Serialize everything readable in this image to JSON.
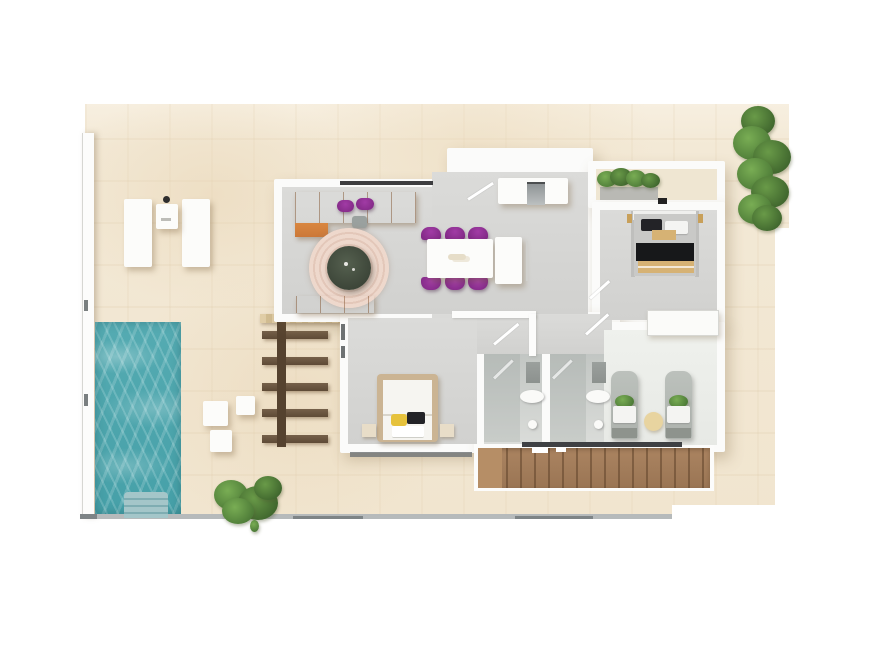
{
  "meta": {
    "title": "3D floor plan rendering of a single-storey villa with pool",
    "render_style": "top-down 3D architectural visualization",
    "visible_text": "none"
  },
  "palette": {
    "page_background": "#ffffff",
    "ground_sand": "#f3e9d6",
    "pool_water": "#4ba4ab",
    "pool_steps": "#a4c6c9",
    "interior_floor": "#d6d6d4",
    "bathroom_floor": "#c6cac7",
    "walls_white": "#fbfbfa",
    "sofa_orange": "#d07c3b",
    "accent_purple": "#8b2e90",
    "rug_pink": "#e8d0c3",
    "coffee_table_green": "#434c3e",
    "stairs_wood": "#a07b59",
    "pergola_brown": "#65503b",
    "plant_green": "#5d8f44",
    "bed_blanket_black": "#17181a",
    "bed_wood_tan": "#d6b274",
    "bed_frame_beige": "#cbb493",
    "pillow_yellow": "#e6c23c",
    "boundary_gray": "#b6babb",
    "railing_dark": "#3f4144"
  },
  "scene": {
    "areas": [
      {
        "id": "pool",
        "label": "Swimming pool"
      },
      {
        "id": "pool-steps",
        "label": "Pool steps"
      },
      {
        "id": "terrace",
        "label": "Sun terrace"
      },
      {
        "id": "sun-loungers",
        "label": "Two sun loungers with side table"
      },
      {
        "id": "poufs",
        "label": "Three round outdoor poufs"
      },
      {
        "id": "pergola",
        "label": "Pergola with wooden slats"
      },
      {
        "id": "living-room",
        "label": "Living room with orange corner sofa and round rug"
      },
      {
        "id": "dining-area",
        "label": "Dining table with six purple chairs"
      },
      {
        "id": "kitchen",
        "label": "Kitchen counter with island"
      },
      {
        "id": "entry",
        "label": "Entrance with door swing"
      },
      {
        "id": "bedroom-1",
        "label": "Double bedroom with black and tan bedding"
      },
      {
        "id": "balcony",
        "label": "Planter balcony with greenery"
      },
      {
        "id": "master-bedroom",
        "label": "Master bedroom with beige-framed bed"
      },
      {
        "id": "bathroom-1",
        "label": "Bathroom with shower, sink and toilet"
      },
      {
        "id": "bathroom-2",
        "label": "Bathroom with shower, sink and toilet"
      },
      {
        "id": "twin-room",
        "label": "Room with two single beds and wardrobe"
      },
      {
        "id": "corridor",
        "label": "Hallway"
      },
      {
        "id": "staircase",
        "label": "Wooden staircase with dark railing"
      },
      {
        "id": "tree",
        "label": "Tall green tree"
      },
      {
        "id": "bush",
        "label": "Green garden bush"
      }
    ],
    "counts": {
      "dining_chairs": 6,
      "sofa_cushions_purple": 2,
      "white_poufs": 3,
      "sun_loungers": 2,
      "twin_beds": 2,
      "bathrooms": 2,
      "bedrooms": 3,
      "pergola_slats": 5
    }
  }
}
